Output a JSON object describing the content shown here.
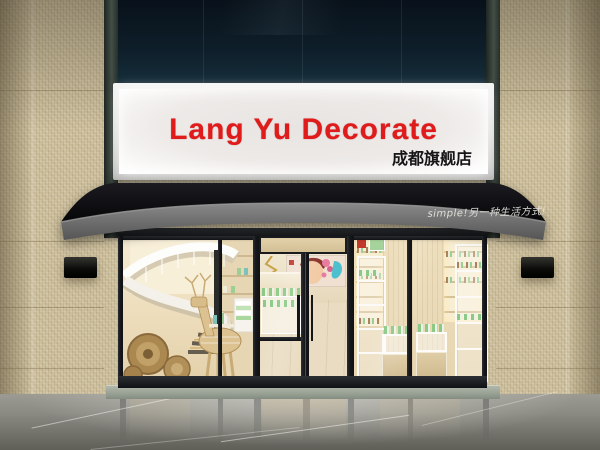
{
  "storefront": {
    "sign": {
      "title": "Lang Yu Decorate",
      "branch": "成都旗舰店"
    },
    "awning": {
      "slogan": "simple!另一种生活方式!"
    },
    "palette": {
      "sign_title_red": "#df1b1b",
      "sign_branch_black": "#161616",
      "sign_panel_white": "#efeceb",
      "awning_canopy_black": "#101014",
      "awning_valance_gray": "#6f6f6f",
      "awning_slogan_white": "#e8e8e2",
      "wall_mosaic_beige": "#cfc2a0",
      "upper_curtainwall_navy": "#0e1c26",
      "window_frame_black": "#1f2124",
      "interior_warm_beige": "#eedfbf",
      "floor_marble_gray": "#84847e",
      "product_green": "#9ccf93",
      "wood_deer_tan": "#dcc290"
    }
  }
}
